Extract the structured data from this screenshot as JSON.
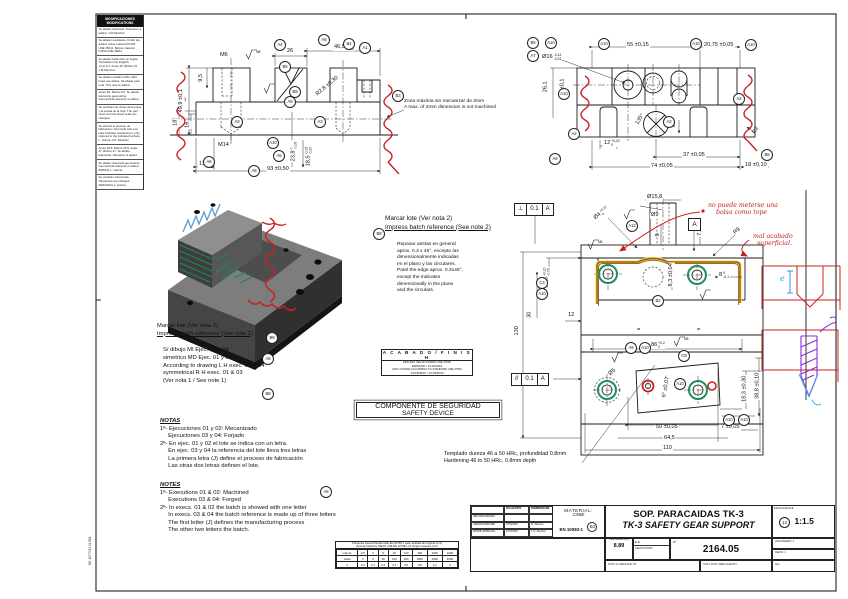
{
  "sheet": {
    "edge_code": "NE 107 P/23 11 881"
  },
  "rev": {
    "header1": "MODIFICACIONES",
    "header2": "MODIFICATIONS",
    "entries": [
      "Se añade tolerancia. Tolerance is added. J.M.Sánchez",
      "Se añaden acabados. Finish are added. Antes material F1150 UNE 36011. Before material F1150 UNE 36011.",
      "Se añade traducción en ingles. Translation into English. +0,1/-0,1. Antes 15. Before 15. J.M.Sánchez",
      "Se añaden taladros Ø12. Ø12 holes are added. Se añade esta nota. This note is added.",
      "Antes R1. Before R1. Se añade tolerancia geométrica. Geometrical tolerance is added.",
      "Se cambian las vistas de la pieza y la escala de la hoja. The part views and the sheet scale are changed.",
      "Se elimina el proceso de fabricación. El temple sólo a la cara indicada. Hardening is only reduced to the indicated surface. L. García  J.M. Sánchez",
      "Antes 25,5. Before 25,5. Antes 47. Before 47. Se añade tolerancia. Tolerance is added.",
      "Se añade tolerancia geométrica. Geometrical tolerance is added. 09/09/11 L. García",
      "Se cambian tolerancias. Tolerances are changed. 28/03/2012 L. García"
    ]
  },
  "labels": {
    "marcar_es": "Marcar lote (Ver nota 2)",
    "marcar_en": "Impress batch reference (See note 2)",
    "max2mm_es": "Zona máxima sin mecanizar de 2mm",
    "max2mm_en": "A max. of 2mm dimension is not machined",
    "templado_es": "Templado dureza 46 a 50 HRc, profundidad 0.8mm",
    "templado_en": "Hardening 46 to 50 HRc, 0.8mm depth",
    "repasar": [
      "Repasar aristas en general",
      "aprox. 0.3 x 45°, excepto las",
      "dimensionalmente indicadas",
      "en el plano y las circulares.",
      "Patel the edge aprox. 0.3x45°,",
      "except the indicates",
      "dimensionally in the plane",
      "and the circulars."
    ],
    "sdibujo": [
      "S/ dibujo MI Ejec. 02 y 04",
      "simetrico MD Ejec. 01 y 03",
      "According to drawing L H exec. 02 & 04",
      "symmetrical R H exec. 01 & 03",
      "(Ver nota 1 / See note 1)"
    ],
    "n8": "N8"
  },
  "notas": {
    "title": "NOTAS",
    "lines": [
      "1ª- Ejecuciones 01 y 02: Mecanizado",
      "     Ejecuciones 03 y 04: Forjado",
      "2ª- En ejec. 01 y 02 el lote se indica con un letra.",
      "     En ejec. 03 y 04 la referencia del lote lleva tres letras",
      "     La primera letra (J) define el proceso de fabricación",
      "     Las otras dos letras definen el lote."
    ]
  },
  "notes": {
    "title": "NOTES",
    "lines": [
      "1ª- Executions 01 & 02: Machined",
      "     Executions 03 & 04: Forged",
      "2ª- In execs. 01 & 02 the batch is showed with one letter",
      "     In execs. 03 & 04 the batch reference is made up of three letters",
      "     The first letter (J) defines the manufacturing process",
      "     The other two letters the batch."
    ]
  },
  "finish": {
    "title": "A C A B A D O / F I N I S H",
    "l1": "ZINCADO SEGÚN NORMA UNE 37502",
    "l2": "ESPESOR = 10 MICRAS",
    "l3": "ZINC COATED ACCORDING TO STANDARD UNE 37502",
    "l4": "THICKNESS = 10 MICRON"
  },
  "safety": {
    "es": "COMPONENTE DE SEGURIDAD",
    "en": "SAFETY DEVICE"
  },
  "fcf": {
    "perp": "⊥",
    "par": "//",
    "tol": "0.1",
    "datum": "A"
  },
  "dims": {
    "tl_m6": "M6",
    "tl_26": "26",
    "tl_465": "46,5",
    "tl_465u": "0",
    "tl_465d": "-0,20",
    "tl_499": "49,9 ±0,1",
    "tl_95": "9,5",
    "tl_18": "18",
    "tl_16": "16",
    "tl_m14": "M14",
    "tl_238": "23,8",
    "tl_238u": "0",
    "tl_238d": "-0,05",
    "tl_185": "18,5",
    "tl_185u": "-0,05",
    "tl_185d": "-0,20",
    "tl_r28": "R2,8 ±0,30",
    "tl_135": "13,5",
    "tl_93": "93 ±0,50",
    "tr_55": "55 ±0,15",
    "tr_2075": "20,75 ±0,05",
    "tr_o16": "Ø16",
    "tr_o16u": "-0,14",
    "tr_o16d": "-0,24",
    "tr_261": "26,1",
    "tr_10": "10 ±0,1",
    "tr_135": "135°",
    "tr_12": "12",
    "tr_12u": "+0,02",
    "tr_12d": "0",
    "tr_3": "3",
    "tr_37": "37 ±0,05",
    "tr_74": "74 ±0,05",
    "tr_18": "18 ±0,10",
    "tr_r2": "R2",
    "fv_o158": "Ø15,8",
    "fv_o9": "Ø9",
    "fv_o4": "Ø4",
    "fv_o4u": "+0,12",
    "fv_o4d": "0",
    "fv_9": "9",
    "fv_75": "7,5",
    "fv_r9": "R9",
    "fv_145": "14,5",
    "fv_145u": "+0,20",
    "fv_145d": "-0,05",
    "fv_30": "30",
    "fv_130": "130",
    "fv_12": "12",
    "fv_86": "86",
    "fv_86u": "+0,2",
    "fv_86d": "0",
    "fv_8": "8",
    "fv_8u": "0",
    "fv_8d": "-0,1",
    "fv_83": "8,3 ±0,04",
    "fv_o5": "Ø5",
    "fv_6": "6° ±0,07'",
    "fv_50": "50 ±0,05",
    "fv_645": "64,5",
    "fv_110": "110",
    "fv_183": "18,3 ±0,30",
    "fv_388": "38,8 ±0,10",
    "fv_7": "7 ±0,05",
    "eq": "="
  },
  "balloons": {
    "tl_a4": "A4",
    "tl_a8": "A8",
    "tl_b4": "B4",
    "tl_a1": "A1",
    "tl_b5": "B5",
    "tl_b9": "B9",
    "tl_a9": "A9",
    "tl_a3a": "A3",
    "tl_a3b": "A3",
    "tl_a10": "A10",
    "tl_a5": "A5",
    "tl_a6": "A6",
    "tl_a8b": "A8",
    "tl_b3": "B3",
    "tr_b5": "B5",
    "tr_a10a": "A10",
    "tr_a7": "A7",
    "tr_a10b": "A10",
    "tr_a10c": "A10",
    "tr_a10d": "A10",
    "tr_a10e": "A10",
    "tr_a2a": "A2",
    "tr_a2b": "A2",
    "tr_a9": "A9",
    "tr_a3": "A3",
    "tr_b5b": "B5",
    "fv_a12": "A12",
    "fv_b2": "B2",
    "fv_c4": "C4",
    "fv_a10a": "A10",
    "fv_a9": "A9",
    "fv_a10b": "A10",
    "fv_c8": "C8",
    "fv_a10c": "A10",
    "fv_a10d": "A10",
    "fv_a10e": "A10",
    "nb_b8a": "B8",
    "nb_b8b": "B8",
    "nb_b8c": "B8",
    "nb_a8": "A8",
    "notes_a8": "A8",
    "tb_b3": "B3",
    "tb_scale": "13"
  },
  "handwriting": {
    "n1a": "no puede meterse una",
    "n1b": "bolsa como tope",
    "n2a": "mal acabado",
    "n2b": "superficial.",
    "e": "e"
  },
  "titleblock": {
    "hdr_date": "FECHA/DATE",
    "hdr_name": "NOMBRE/NAME",
    "r1l": "DIBUJADO/DRAWN",
    "r1d": "",
    "r1n": "",
    "r2l": "CREADO/CREATED",
    "r2d": "27/04/2007",
    "r2n": "M. Sánchez",
    "r3l": "APROB./APPROVAL",
    "r3d": "27/04/2007",
    "r3n": "J. R. Sánchez",
    "mat_label": "MATERIAL:",
    "mat1": "C55E",
    "mat2": "EN 10083-1",
    "title_es": "SOP. PARACAIDAS TK-3",
    "title_en": "TK-3 SAFETY GEAR SUPPORT",
    "scale_label": "ESCALA/SCALE",
    "scale": "1:1.5",
    "weight_label": "PESO/WEIGHT(KG)",
    "weight": "8.89",
    "ee": "E.E.",
    "count_label": "CANT./COUNT.",
    "num_label": "Nº",
    "num": "2164.05",
    "sheet_label": "HOJA/SHEET: 1",
    "of_label": "DE/OF: 1",
    "repl_to": "SUST. A / REPLACE TO:",
    "repl_by": "SUST. POR / REPLACED BY:",
    "rev_label": "Rev."
  },
  "toltable": {
    "title_es": "Tolerancia General Media UNE-EN 22768-1 para medidas de longitud (mm)",
    "title_en": "General tolerance MEAN UNE-EN 22768-1 for length measure (mm)",
    "c0a": "más de",
    "c0b": "hasta",
    "pm": "±",
    "rt": [
      "0,5",
      "3",
      "6",
      "30",
      "120",
      "400",
      "1000",
      "2000"
    ],
    "rb": [
      "3",
      "6",
      "30",
      "120",
      "400",
      "1000",
      "2000",
      "4000"
    ],
    "v": [
      "0,1",
      "0,1",
      "0,2",
      "0,3",
      "0,5",
      "0,8",
      "1,2",
      "2"
    ]
  }
}
